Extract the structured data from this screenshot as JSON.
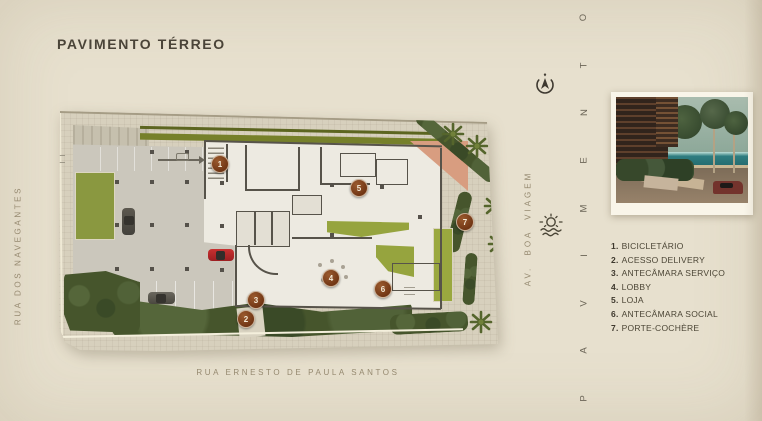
{
  "page": {
    "title": "PAVIMENTO TÉRREO",
    "background_color": "#e7e0ce"
  },
  "streets": {
    "left": "RUA DOS NAVEGANTES",
    "bottom": "RUA ERNESTO DE PAULA SANTOS",
    "right": "AV. BOA VIAGEM"
  },
  "side_word": {
    "text": "PAVIMENTO"
  },
  "legend": {
    "items": [
      {
        "num": "1.",
        "label": "BICICLETÁRIO"
      },
      {
        "num": "2.",
        "label": "ACESSO DELIVERY"
      },
      {
        "num": "3.",
        "label": "ANTECÂMARA SERVIÇO"
      },
      {
        "num": "4.",
        "label": "LOBBY"
      },
      {
        "num": "5.",
        "label": "LOJA"
      },
      {
        "num": "6.",
        "label": "ANTECÂMARA SOCIAL"
      },
      {
        "num": "7.",
        "label": "PORTE-COCHÈRE"
      }
    ]
  },
  "plan": {
    "markers": [
      {
        "n": "1"
      },
      {
        "n": "2"
      },
      {
        "n": "3"
      },
      {
        "n": "4"
      },
      {
        "n": "5"
      },
      {
        "n": "6"
      },
      {
        "n": "7"
      }
    ]
  },
  "icons": {
    "compass": "north-compass",
    "sun": "sun-over-sea"
  },
  "colors": {
    "marker_brown": "#7d3f1c",
    "olive_green": "#76802a",
    "lawn_green": "#8a9840",
    "hedge_green": "#46552c",
    "terracotta": "#d89d80",
    "title_text": "#4a4438",
    "street_text": "#95896f"
  }
}
